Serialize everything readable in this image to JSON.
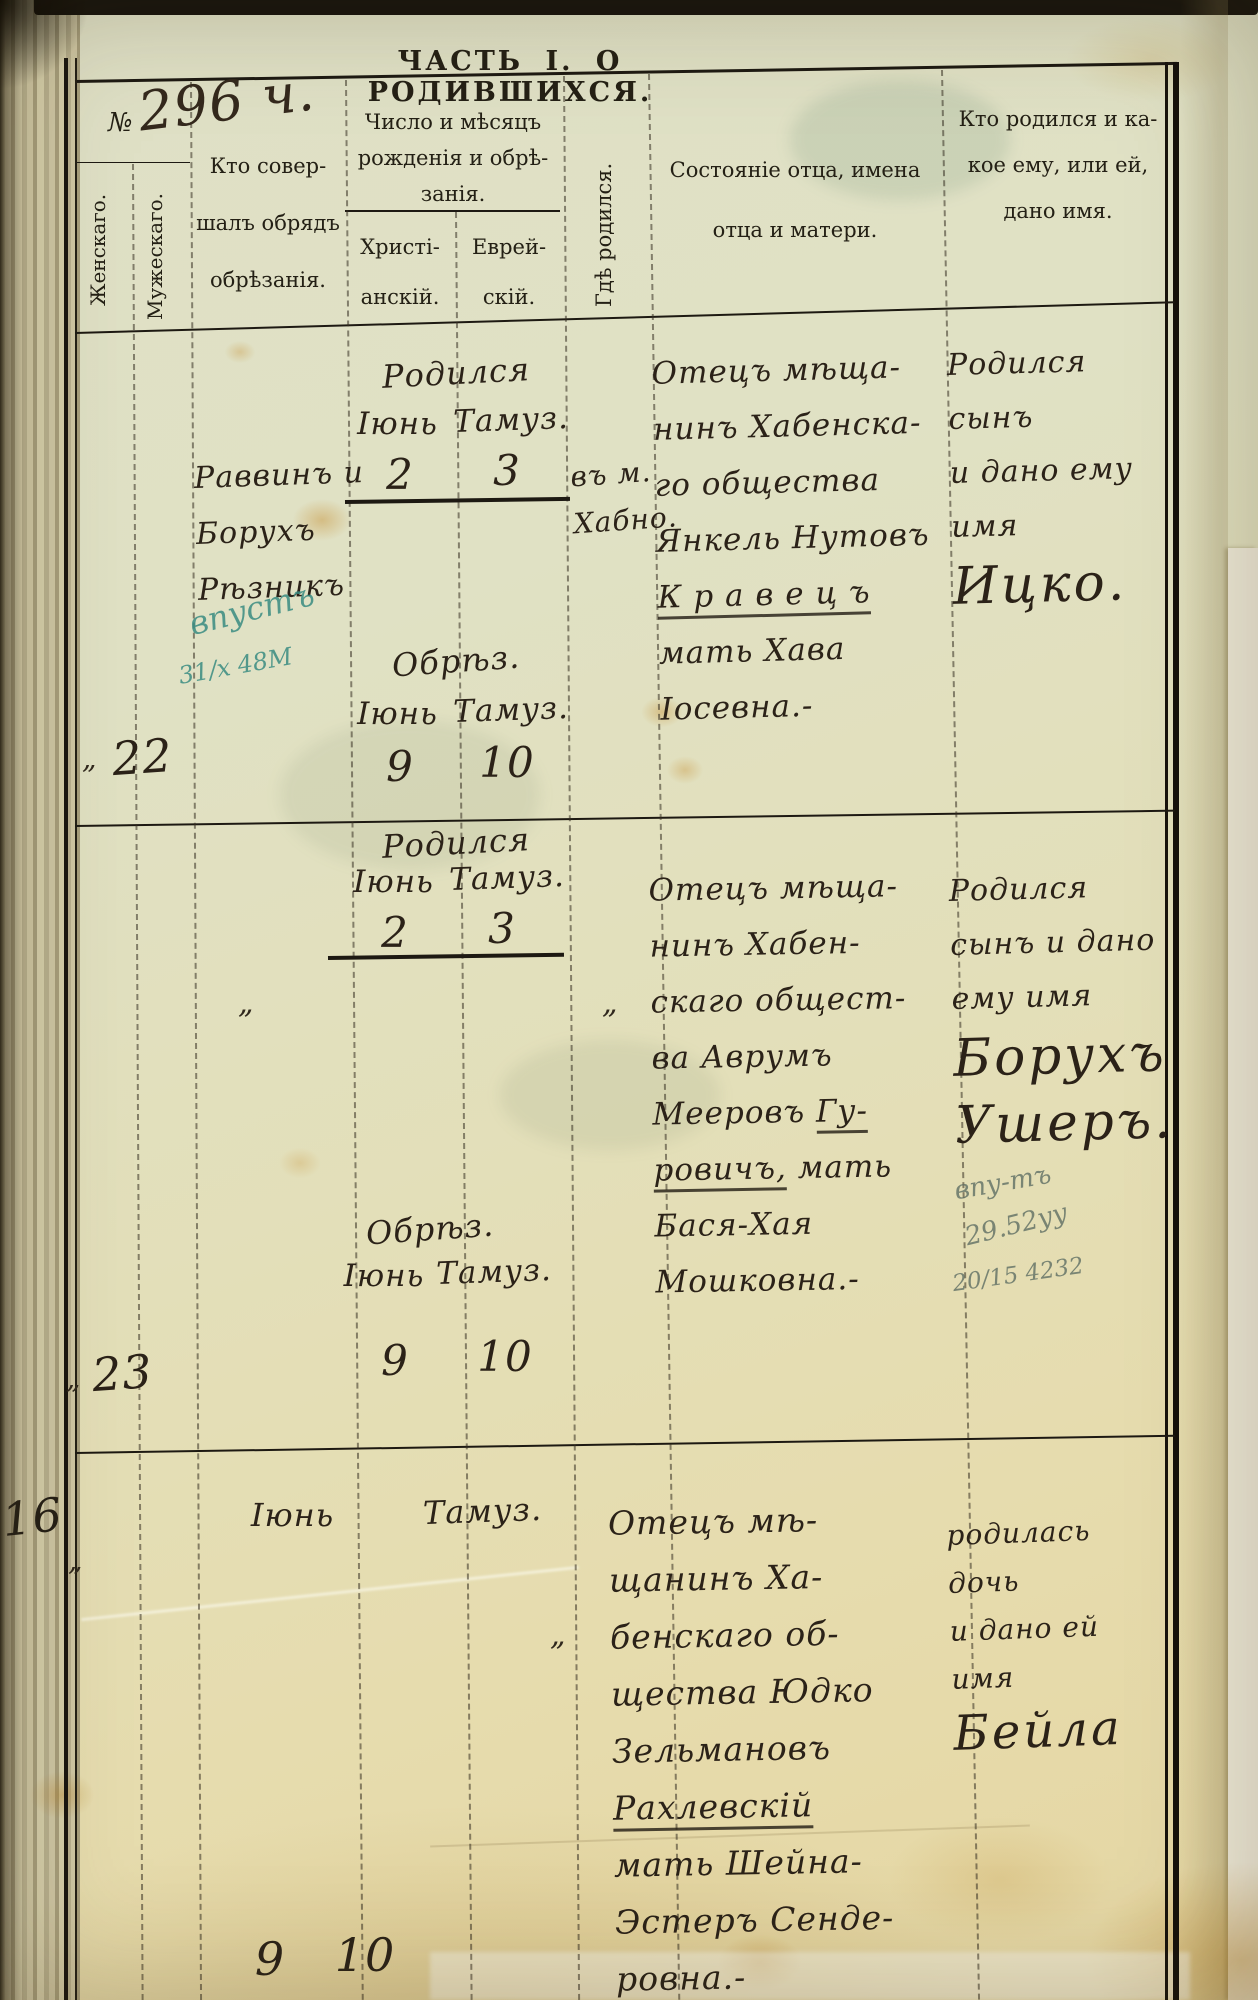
{
  "page": {
    "title": "ЧАСТЬ I. О РОДИВШИХСЯ.",
    "register_no": "296 ч.",
    "folio_no": "16"
  },
  "header": {
    "no": "№",
    "female": "Женскаго.",
    "male": "Мужескаго.",
    "officiant": "Кто совер-\nшалъ обрядъ\nобрѣзанія.",
    "dates": "Число и мѣсяцъ\nрожденія и обрѣ-\nзанія.",
    "christian": "Христі-\nанскій.",
    "jewish": "Еврей-\nскій.",
    "where_born": "Гдѣ родился.",
    "father": "Состояніе отца, имена\nотца и матери.",
    "who_born": "Кто родился и ка-\nкое ему, или ей,\nдано имя."
  },
  "entries": [
    {
      "tick": "„",
      "no": "22",
      "officiant": "Раввинъ и\nБорухъ\nРѣзникъ",
      "birth": {
        "label": "Родился",
        "month_chr": "Іюнь",
        "month_jew": "Тамуз.",
        "day_chr": "2",
        "day_jew": "3"
      },
      "circumcision": {
        "label": "Обрѣз.",
        "month_chr": "Іюнь",
        "month_jew": "Тамуз.",
        "day_chr": "9",
        "day_jew": "10"
      },
      "where_born": "въ м.\nХабно.",
      "father_lines": [
        [
          "Отецъ мѣща-"
        ],
        [
          "нинъ Хабенска-"
        ],
        [
          "го общества"
        ],
        [
          "Янкель Нутовъ"
        ],
        [
          {
            "t": "К р а в е ц ъ",
            "u": true
          }
        ],
        [
          "мать Хава"
        ],
        [
          "Іосевна.-"
        ]
      ],
      "name_lines": [
        [
          "Родился сынъ"
        ],
        [
          "и дано ему"
        ],
        [
          "имя"
        ],
        [
          {
            "t": "Ицко.",
            "big": true
          }
        ]
      ],
      "annotation": [
        "впустъ",
        "31/х 48М"
      ]
    },
    {
      "tick": "„",
      "no": "23",
      "officiant_ditto": "„",
      "birth": {
        "label": "Родился",
        "month_chr": "Іюнь",
        "month_jew": "Тамуз.",
        "day_chr": "2",
        "day_jew": "3"
      },
      "circumcision": {
        "label": "Обрѣз.",
        "month_chr": "Іюнь",
        "month_jew": "Тамуз.",
        "day_chr": "9",
        "day_jew": "10"
      },
      "where_born_ditto": "„",
      "father_lines": [
        [
          "Отецъ мѣща-"
        ],
        [
          "нинъ Хабен-"
        ],
        [
          "скаго общест-"
        ],
        [
          "ва Аврумъ"
        ],
        [
          "Мееровъ ",
          {
            "t": "Гу-",
            "u": true
          }
        ],
        [
          {
            "t": "ровичъ,",
            "u": true
          },
          {
            "t": " мать"
          }
        ],
        [
          "Бася-Хая"
        ],
        [
          "Мошковна.-"
        ]
      ],
      "name_lines": [
        [
          "Родился"
        ],
        [
          "сынъ и дано"
        ],
        [
          "ему имя"
        ],
        [
          {
            "t": "Борухъ",
            "big": true
          }
        ],
        [
          {
            "t": "Ушеръ.",
            "big": true
          }
        ]
      ],
      "annotation": [
        "впу-тъ",
        "29.52уу",
        "20/15 4232"
      ]
    },
    {
      "tick": "„",
      "birth": {
        "month_chr": "Іюнь",
        "month_jew": "Тамуз."
      },
      "circumcision": {
        "day_chr": "9",
        "day_jew": "10"
      },
      "where_born_ditto": "„",
      "father_lines": [
        [
          "Отецъ мѣ-"
        ],
        [
          "щанинъ Ха-"
        ],
        [
          "бенскаго об-"
        ],
        [
          "щества Юдко"
        ],
        [
          "Зельмановъ"
        ],
        [
          {
            "t": "Рахлевскій",
            "u": true
          }
        ],
        [
          "мать Шейна-"
        ],
        [
          "Эстеръ Сенде-"
        ],
        [
          "ровна.-"
        ]
      ],
      "name_lines": [
        [
          "родилась дочь"
        ],
        [
          "и дано ей"
        ],
        [
          "имя"
        ],
        [
          {
            "t": "Бейла",
            "big": true
          }
        ]
      ]
    }
  ]
}
